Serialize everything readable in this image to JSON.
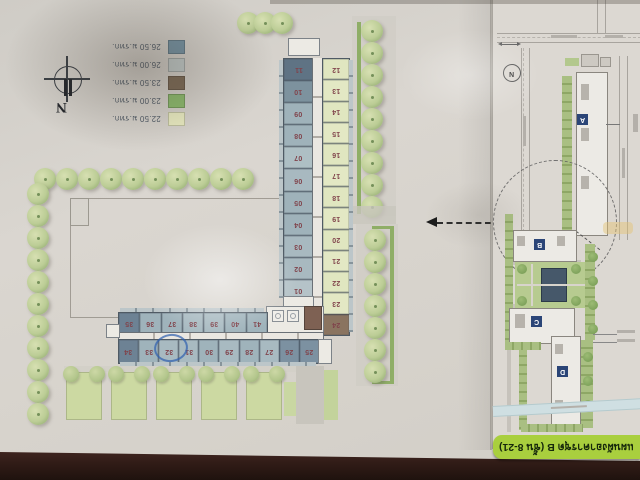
{
  "photo": {
    "table_color": "#3a241c",
    "paper_color": "#d8d4ce",
    "overview_sheet_color": "#dcd8d2",
    "orientation_note": "plan photographed upside-down"
  },
  "legend": {
    "items": [
      {
        "label": "26.50 ม.รทก.",
        "color": "#7593a4"
      },
      {
        "label": "26.00 ม.รทก.",
        "color": "#c2cbca"
      },
      {
        "label": "23.50 ม.รทก.",
        "color": "#7c6a56"
      },
      {
        "label": "23.00 ม.รทก.",
        "color": "#8cbb6d"
      },
      {
        "label": "22.50 ม.รทก.",
        "color": "#eaecc2"
      }
    ]
  },
  "compass": {
    "letter": "N"
  },
  "buildings": {
    "vertical_wing": {
      "west_units": [
        {
          "no": "11",
          "color": "#5f7384"
        },
        {
          "no": "10",
          "color": "#7d929e"
        },
        {
          "no": "09",
          "color": "#9fb2ba"
        },
        {
          "no": "08",
          "color": "#9fb2ba"
        },
        {
          "no": "07",
          "color": "#aebfc4"
        },
        {
          "no": "06",
          "color": "#a8b9c0"
        },
        {
          "no": "05",
          "color": "#9fb2ba"
        },
        {
          "no": "04",
          "color": "#9fb2ba"
        },
        {
          "no": "03",
          "color": "#a8b9c0"
        },
        {
          "no": "02",
          "color": "#a8b9c0"
        },
        {
          "no": "01",
          "color": "#b5c3c8"
        }
      ],
      "east_units": [
        {
          "no": "12",
          "color": "#e0e6c0"
        },
        {
          "no": "13",
          "color": "#e3e8c4"
        },
        {
          "no": "14",
          "color": "#e0e6c0"
        },
        {
          "no": "15",
          "color": "#e3e8c4"
        },
        {
          "no": "16",
          "color": "#e0e6c0"
        },
        {
          "no": "17",
          "color": "#e3e8c4"
        },
        {
          "no": "18",
          "color": "#e0e6c0"
        },
        {
          "no": "19",
          "color": "#e3e8c4"
        },
        {
          "no": "20",
          "color": "#e0e6c0"
        },
        {
          "no": "21",
          "color": "#e3e8c4"
        },
        {
          "no": "22",
          "color": "#e0e6c0"
        },
        {
          "no": "23",
          "color": "#e3e8c4"
        },
        {
          "no": "24",
          "color": "#8a7460"
        }
      ]
    },
    "horizontal_wing": {
      "north_units": [
        {
          "no": "35",
          "color": "#6d8294"
        },
        {
          "no": "36",
          "color": "#9fb3bb"
        },
        {
          "no": "37",
          "color": "#9fb3bb"
        },
        {
          "no": "38",
          "color": "#a8bac1"
        },
        {
          "no": "39",
          "color": "#a8bac1"
        },
        {
          "no": "40",
          "color": "#9fb3bb"
        },
        {
          "no": "41",
          "color": "#9fb3bb"
        }
      ],
      "south_units": [
        {
          "no": "34",
          "color": "#6d8294"
        },
        {
          "no": "33",
          "color": "#9fb3bb"
        },
        {
          "no": "32",
          "color": "#a8bac1"
        },
        {
          "no": "31",
          "color": "#a8bac1"
        },
        {
          "no": "30",
          "color": "#9fb3bb"
        },
        {
          "no": "29",
          "color": "#a8bac1"
        },
        {
          "no": "28",
          "color": "#9fb3bb"
        },
        {
          "no": "27",
          "color": "#a8bac1"
        },
        {
          "no": "26",
          "color": "#7c91a1"
        },
        {
          "no": "25",
          "color": "#7c91a1"
        }
      ]
    },
    "circled_unit": "32"
  },
  "landscape": {
    "top_row_trees": 10,
    "left_column_trees": 11,
    "cluster_trees": 3,
    "east_strip_upper_trees": 9,
    "east_strip_lower_trees": 7,
    "garden_plots": 5
  },
  "overview": {
    "north_letter": "N",
    "building_labels": [
      {
        "label": "A"
      },
      {
        "label": "B"
      },
      {
        "label": "C"
      },
      {
        "label": "D"
      }
    ],
    "label_chip_color": "#2b4577"
  },
  "banner": {
    "text": "แผนผังอาคารชุด B (ชั้น 8-21)",
    "bg_color": "#a9cf3e",
    "text_color": "#16280b"
  }
}
